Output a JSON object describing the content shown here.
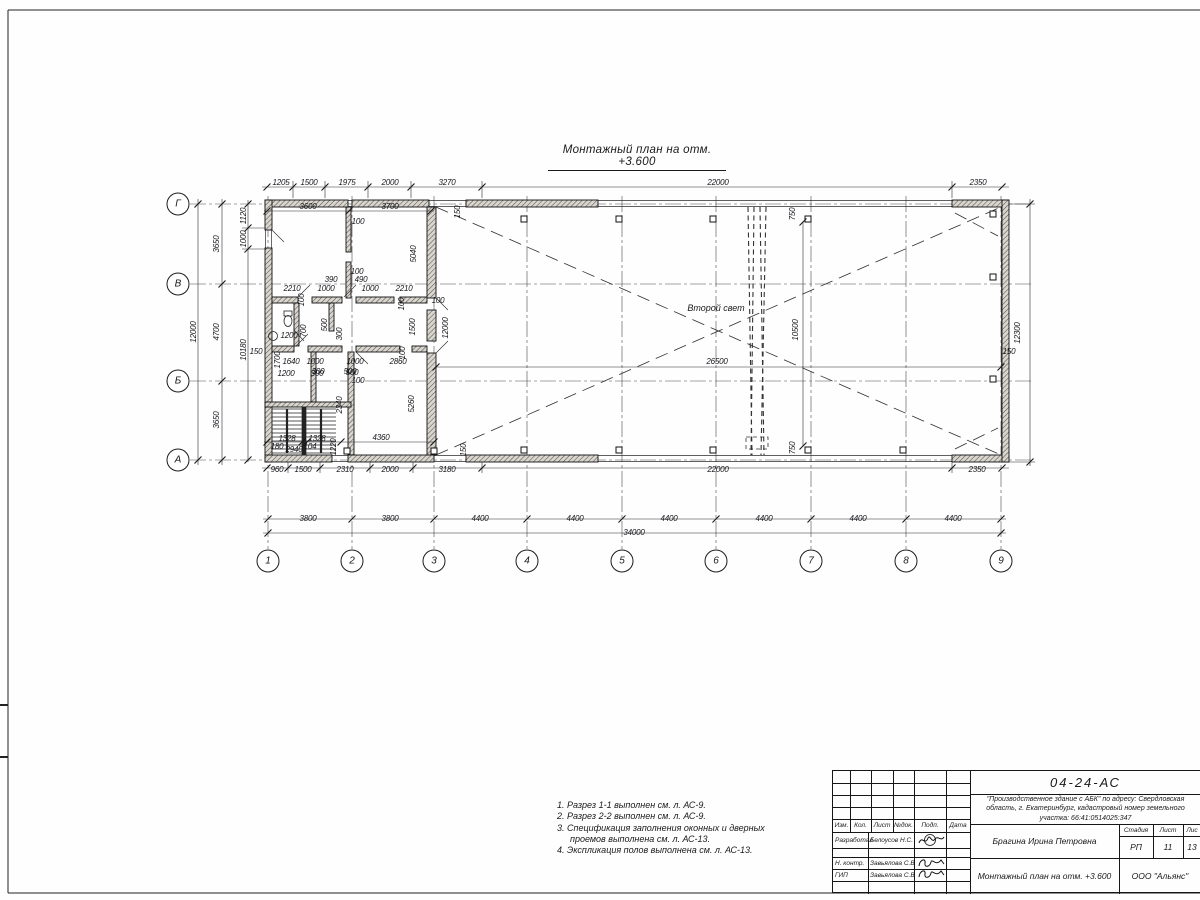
{
  "colors": {
    "ink": "#1c1c1c",
    "paper": "#fefefe",
    "wall_fill": "#d9d6cf"
  },
  "sheet": {
    "title": "Монтажный план на отм. +3.600",
    "hall_label": "Второй свет"
  },
  "grid": {
    "cols": [
      {
        "label": "1",
        "x": 268
      },
      {
        "label": "2",
        "x": 352
      },
      {
        "label": "3",
        "x": 434
      },
      {
        "label": "4",
        "x": 527
      },
      {
        "label": "5",
        "x": 622
      },
      {
        "label": "6",
        "x": 716
      },
      {
        "label": "7",
        "x": 811
      },
      {
        "label": "8",
        "x": 906
      },
      {
        "label": "9",
        "x": 1001
      }
    ],
    "rows": [
      {
        "label": "Г",
        "y": 204
      },
      {
        "label": "В",
        "y": 284
      },
      {
        "label": "Б",
        "y": 381
      },
      {
        "label": "А",
        "y": 460
      }
    ]
  },
  "dims": [
    [
      "1205",
      281,
      183,
      0
    ],
    [
      "1500",
      309,
      183,
      0
    ],
    [
      "1975",
      347,
      183,
      0
    ],
    [
      "2000",
      390,
      183,
      0
    ],
    [
      "3270",
      447,
      183,
      0
    ],
    [
      "22000",
      718,
      183,
      0
    ],
    [
      "2350",
      978,
      183,
      0
    ],
    [
      "3600",
      308,
      207,
      0
    ],
    [
      "3700",
      390,
      207,
      0
    ],
    [
      "150",
      458,
      212,
      1
    ],
    [
      "750",
      793,
      214,
      1
    ],
    [
      "12000",
      194,
      332,
      1
    ],
    [
      "3650",
      217,
      244,
      1
    ],
    [
      "4700",
      217,
      332,
      1
    ],
    [
      "3650",
      217,
      420,
      1
    ],
    [
      "1120",
      244,
      216,
      1
    ],
    [
      "1000",
      244,
      239,
      1
    ],
    [
      "10180",
      244,
      350,
      1
    ],
    [
      "150",
      256,
      352,
      0
    ],
    [
      "12300",
      1018,
      333,
      1
    ],
    [
      "150",
      1009,
      352,
      0
    ],
    [
      "26500",
      717,
      362,
      0
    ],
    [
      "10500",
      796,
      330,
      1
    ],
    [
      "750",
      793,
      448,
      1
    ],
    [
      "150",
      464,
      450,
      1
    ],
    [
      "1220",
      334,
      447,
      1
    ],
    [
      "960",
      277,
      470,
      0
    ],
    [
      "1500",
      303,
      470,
      0
    ],
    [
      "2310",
      345,
      470,
      0
    ],
    [
      "2000",
      390,
      470,
      0
    ],
    [
      "3180",
      447,
      470,
      0
    ],
    [
      "22000",
      718,
      470,
      0
    ],
    [
      "2350",
      977,
      470,
      0
    ],
    [
      "3800",
      308,
      519,
      0
    ],
    [
      "3800",
      390,
      519,
      0
    ],
    [
      "4400",
      480,
      519,
      0
    ],
    [
      "4400",
      575,
      519,
      0
    ],
    [
      "4400",
      669,
      519,
      0
    ],
    [
      "4400",
      764,
      519,
      0
    ],
    [
      "4400",
      858,
      519,
      0
    ],
    [
      "4400",
      953,
      519,
      0
    ],
    [
      "34000",
      634,
      533,
      0
    ],
    [
      "2210",
      292,
      289,
      0
    ],
    [
      "390",
      331,
      280,
      0
    ],
    [
      "1000",
      326,
      289,
      0
    ],
    [
      "490",
      361,
      280,
      0
    ],
    [
      "1000",
      370,
      289,
      0
    ],
    [
      "2210",
      404,
      289,
      0
    ],
    [
      "100",
      358,
      222,
      0
    ],
    [
      "100",
      357,
      272,
      0
    ],
    [
      "5040",
      414,
      254,
      1
    ],
    [
      "100",
      302,
      300,
      1
    ],
    [
      "100",
      402,
      304,
      1
    ],
    [
      "100",
      438,
      301,
      0
    ],
    [
      "500",
      325,
      325,
      1
    ],
    [
      "700",
      304,
      331,
      1
    ],
    [
      "300",
      340,
      334,
      1
    ],
    [
      "1200",
      289,
      336,
      0
    ],
    [
      "1500",
      413,
      327,
      1
    ],
    [
      "12000",
      446,
      328,
      1
    ],
    [
      "1700",
      278,
      360,
      1
    ],
    [
      "1640",
      291,
      362,
      0
    ],
    [
      "1000",
      315,
      362,
      0
    ],
    [
      "300",
      318,
      372,
      0
    ],
    [
      "1000",
      355,
      362,
      0
    ],
    [
      "500",
      350,
      372,
      0
    ],
    [
      "2860",
      398,
      362,
      0
    ],
    [
      "100",
      403,
      353,
      1
    ],
    [
      "1200",
      286,
      374,
      0
    ],
    [
      "300",
      317,
      374,
      0
    ],
    [
      "500",
      352,
      373,
      0
    ],
    [
      "100",
      358,
      381,
      0
    ],
    [
      "2340",
      340,
      405,
      1
    ],
    [
      "5260",
      412,
      404,
      1
    ],
    [
      "1328",
      287,
      439,
      0
    ],
    [
      "1328",
      317,
      439,
      0
    ],
    [
      "4360",
      381,
      438,
      0
    ],
    [
      "180",
      277,
      447,
      0
    ],
    [
      "2940",
      294,
      450,
      0
    ],
    [
      "104",
      310,
      447,
      0
    ]
  ],
  "notes": [
    {
      "text": "1. Разрез 1-1 выполнен см. л. АС-9.",
      "cont": false
    },
    {
      "text": "2. Разрез 2-2 выполнен см. л. АС-9.",
      "cont": false
    },
    {
      "text": "3. Спецификация заполнения оконных и дверных",
      "cont": false
    },
    {
      "text": "проемов выполнена см. л. АС-13.",
      "cont": true
    },
    {
      "text": "4. Экспликация полов выполнена см. л. АС-13.",
      "cont": false
    }
  ],
  "title_block": {
    "doc_number": "04-24-АС",
    "project": [
      "\"Производственное здание с АБК\" по адресу: Свердловская",
      "область, г. Екатеринбург, кадастровый номер земельного",
      "участка: 66:41:0514025:347"
    ],
    "columns": [
      "Изм.",
      "Кол.",
      "Лист",
      "№док.",
      "Подп.",
      "Дата"
    ],
    "rows": [
      {
        "role": "Разработал",
        "name": "Белоусов Н.С."
      },
      {
        "role": "Н. контр.",
        "name": "Завьялова С.В"
      },
      {
        "role": "ГИП",
        "name": "Завьялова С.В"
      }
    ],
    "person": "Брагина Ирина Петровна",
    "drawing_title": "Монтажный план на отм. +3.600",
    "stage_header": [
      "Стадия",
      "Лист",
      "Лис"
    ],
    "stage_values": [
      "РП",
      "11",
      "13"
    ],
    "company": "ООО \"Альянс\""
  }
}
